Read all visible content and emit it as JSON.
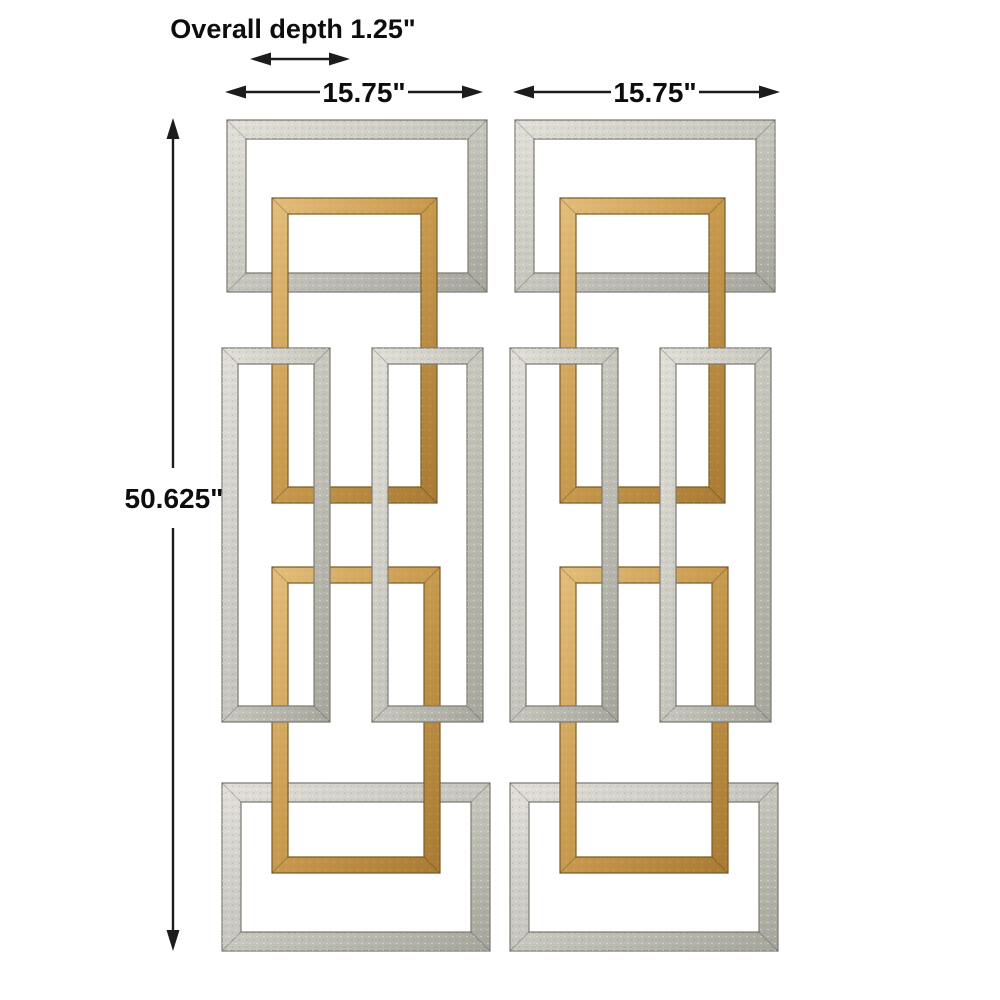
{
  "annotations": {
    "depth_label": "Overall depth 1.25\"",
    "height_label": "50.625\"",
    "panel_left_width_label": "15.75\"",
    "panel_right_width_label": "15.75\""
  },
  "dimensions_shown": {
    "overall_depth_in": 1.25,
    "overall_height_in": 50.625,
    "panel_width_in": 15.75
  },
  "colors": {
    "background": "#ffffff",
    "arrow": "#1c1c1c",
    "text": "#0d0d0d",
    "silver_light": "#e2e0d8",
    "silver_mid": "#c7c6bd",
    "silver_dark": "#a6a59b",
    "silver_outline": "#7c7b73",
    "gold_light": "#e3be7c",
    "gold_mid": "#cb9d51",
    "gold_dark": "#a87a33",
    "gold_outline": "#7d5c26"
  },
  "diagram": {
    "panels": [
      {
        "name": "panel-left",
        "dx": 0
      },
      {
        "name": "panel-right",
        "dx": 288
      }
    ],
    "frames": [
      {
        "name": "top-silver-frame",
        "material": "silver",
        "x": 227,
        "y": 120,
        "w": 260,
        "h": 172,
        "t": 19
      },
      {
        "name": "bottom-silver-frame",
        "material": "silver",
        "x": 222,
        "y": 783,
        "w": 268,
        "h": 168,
        "t": 19
      },
      {
        "name": "upper-gold-frame",
        "material": "gold",
        "x": 272,
        "y": 198,
        "w": 165,
        "h": 305,
        "t": 16
      },
      {
        "name": "lower-gold-frame",
        "material": "gold",
        "x": 272,
        "y": 567,
        "w": 168,
        "h": 306,
        "t": 16
      },
      {
        "name": "mid-left-silver-frame",
        "material": "silver",
        "x": 222,
        "y": 348,
        "w": 108,
        "h": 374,
        "t": 16
      },
      {
        "name": "mid-right-silver-frame",
        "material": "silver",
        "x": 372,
        "y": 348,
        "w": 111,
        "h": 374,
        "t": 16
      }
    ],
    "arrows": [
      {
        "name": "depth-arrow",
        "type": "h",
        "x1": 250,
        "x2": 350,
        "y": 59
      },
      {
        "name": "width-arrow-left",
        "type": "h-split",
        "x1": 225,
        "x2": 483,
        "y": 92,
        "gap1": 320,
        "gap2": 408
      },
      {
        "name": "width-arrow-right",
        "type": "h-split",
        "x1": 513,
        "x2": 780,
        "y": 92,
        "gap1": 611,
        "gap2": 699
      },
      {
        "name": "height-arrow",
        "type": "v-split",
        "x": 173,
        "y1": 118,
        "y2": 951,
        "gap1": 468,
        "gap2": 528
      }
    ]
  }
}
